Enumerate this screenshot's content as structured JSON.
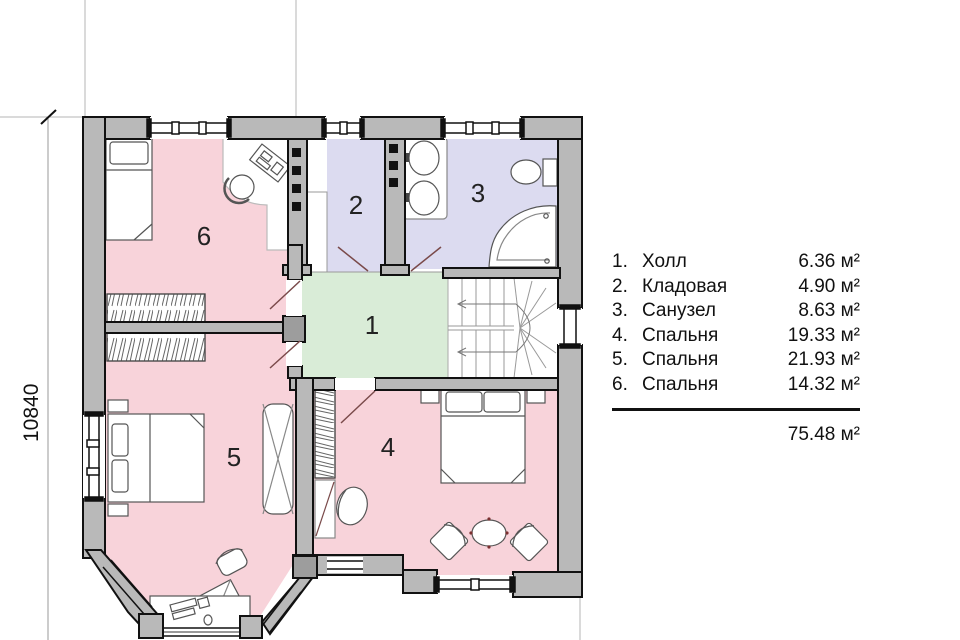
{
  "plan": {
    "dimension_left": "10840",
    "room_labels": {
      "hall": "1",
      "storage": "2",
      "bathroom": "3",
      "bedroom4": "4",
      "bedroom5": "5",
      "bedroom6": "6"
    },
    "colors": {
      "bedroom_fill": "#f8d3da",
      "wet_room_fill": "#dcdbf0",
      "hall_fill": "#d9ecd7",
      "wall_fill": "#b9b9b9",
      "line": "#111111"
    }
  },
  "legend": {
    "items": [
      {
        "num": "1.",
        "name": "Холл",
        "area": "6.36 м²"
      },
      {
        "num": "2.",
        "name": "Кладовая",
        "area": "4.90 м²"
      },
      {
        "num": "3.",
        "name": "Санузел",
        "area": "8.63 м²"
      },
      {
        "num": "4.",
        "name": "Спальня",
        "area": "19.33 м²"
      },
      {
        "num": "5.",
        "name": "Спальня",
        "area": "21.93 м²"
      },
      {
        "num": "6.",
        "name": "Спальня",
        "area": "14.32 м²"
      }
    ],
    "total": "75.48 м²"
  }
}
